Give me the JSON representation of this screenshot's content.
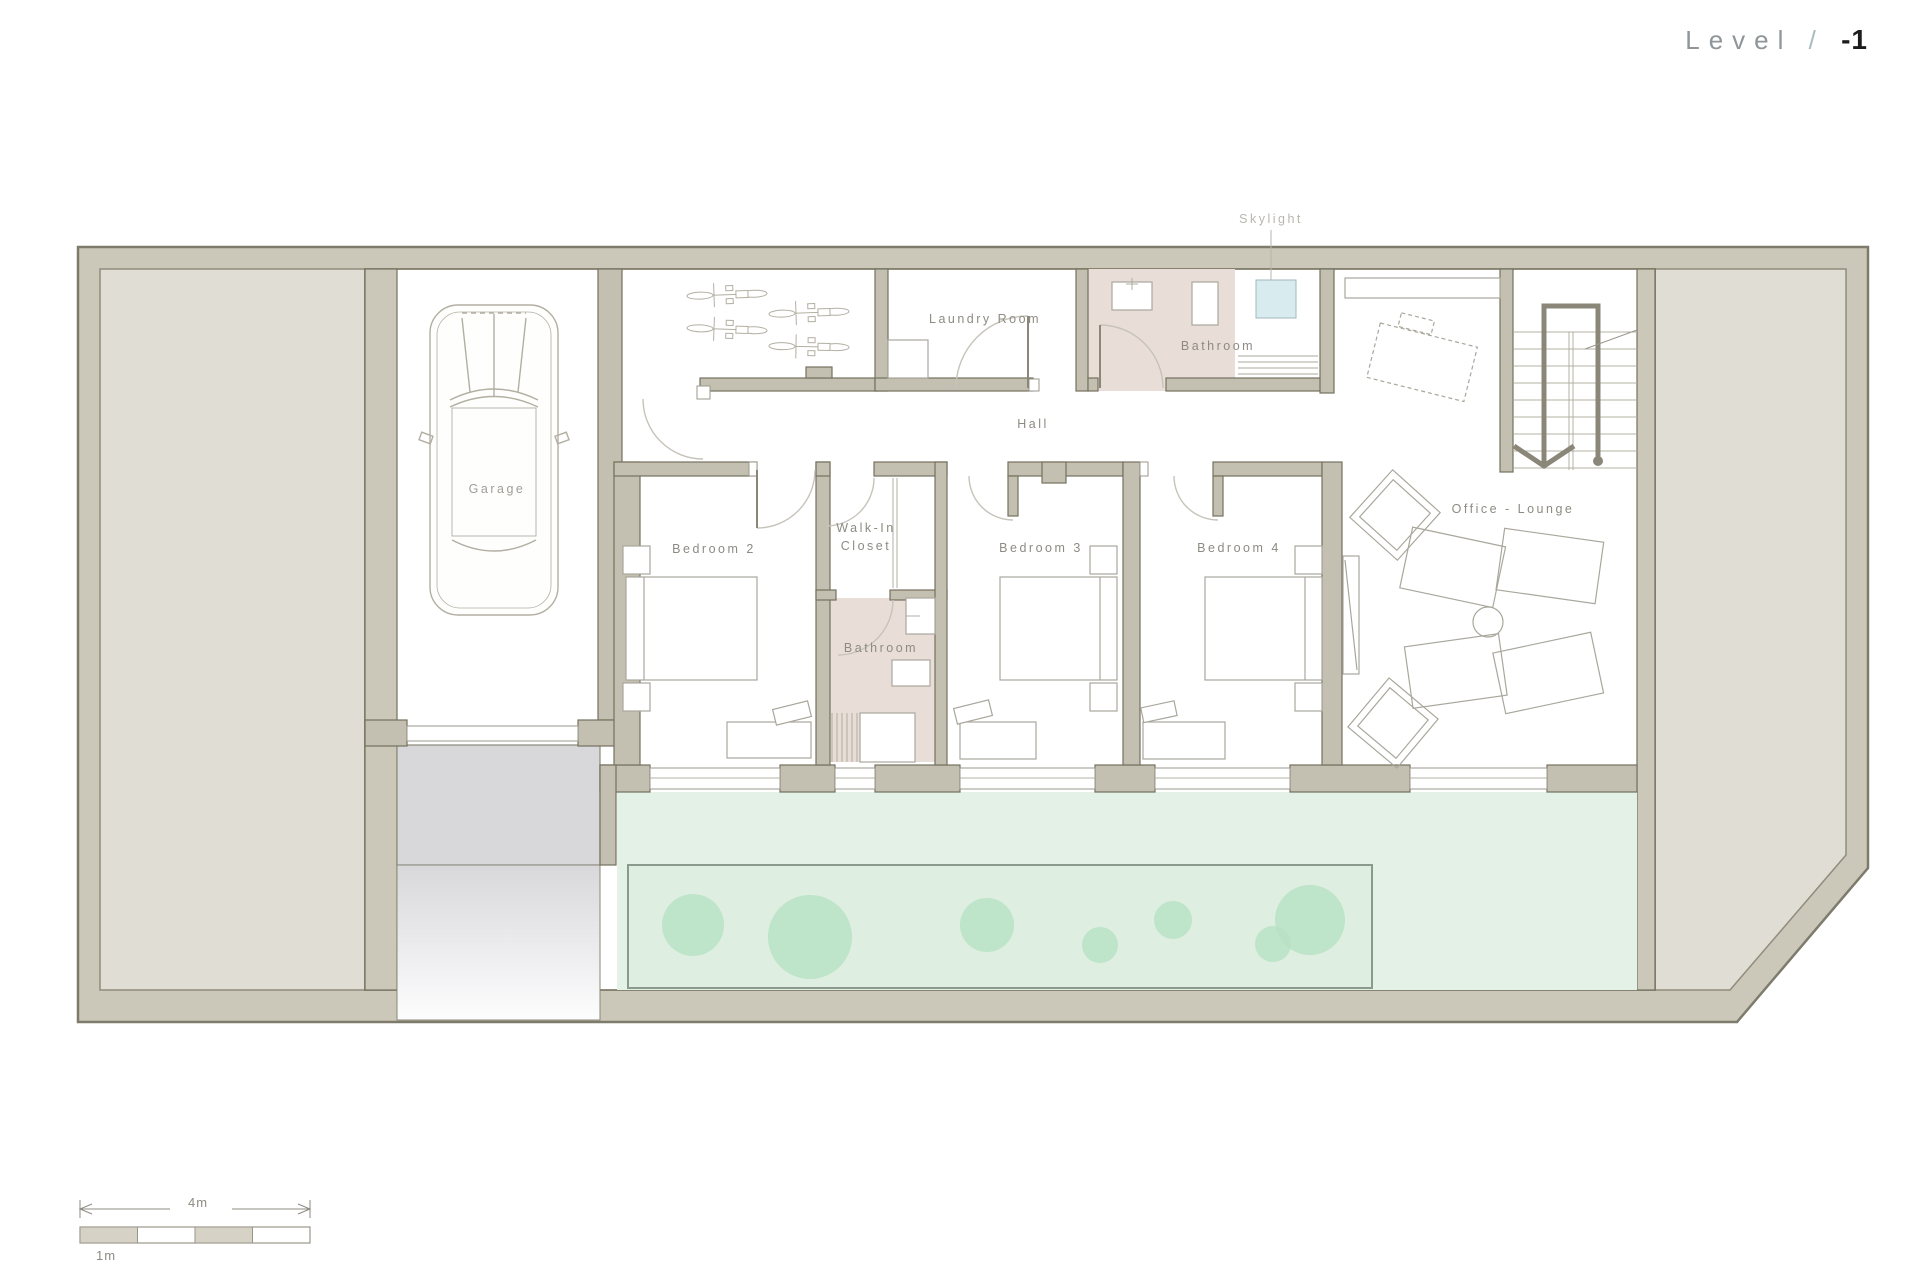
{
  "title": {
    "label": "Level",
    "separator": "/",
    "number": "-1"
  },
  "rooms": {
    "garage": "Garage",
    "laundry": "Laundry Room",
    "bathroom_top": "Bathroom",
    "hall": "Hall",
    "bedroom2": "Bedroom 2",
    "walk_in_closet": "Walk-In Closet",
    "bathroom_mid": "Bathroom",
    "bedroom3": "Bedroom 3",
    "bedroom4": "Bedroom 4",
    "office_lounge": "Office - Lounge"
  },
  "annotations": {
    "skylight": "Skylight"
  },
  "scale_bar": {
    "total_label": "4m",
    "unit_label": "1m"
  },
  "symbols": {
    "car": "car-top-view",
    "bicycles": 4,
    "trees": 7,
    "stair_flight": "stairs-down-arrow"
  },
  "colors": {
    "wall_fill": "#cbc7b9",
    "wall_stroke": "#7e7b6c",
    "partition_fill": "#c4c0b1",
    "partition_stroke": "#74715f",
    "terrain": "#e0ddd4",
    "floor": "#ffffff",
    "bathroom_floor": "#e9ded7",
    "skylight_glass": "#d8ecf0",
    "garden": "#e2f0e4",
    "garden_bed": "#deeee1",
    "tree": "#b9e2c4",
    "driveway": "#d8d8db",
    "furniture_line": "#a9a79c",
    "label_text": "#8d8b82",
    "title_dark": "#1c1c1e",
    "title_gray": "#8f9598"
  }
}
